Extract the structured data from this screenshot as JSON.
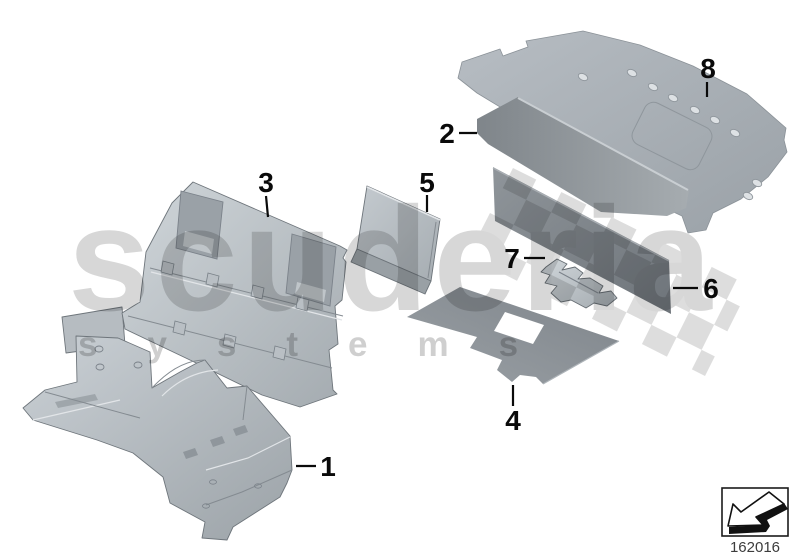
{
  "diagram": {
    "type": "exploded-parts-diagram",
    "subject": "sound insulation panels",
    "callouts": [
      {
        "label": "1"
      },
      {
        "label": "2"
      },
      {
        "label": "3"
      },
      {
        "label": "4"
      },
      {
        "label": "5"
      },
      {
        "label": "6"
      },
      {
        "label": "7"
      },
      {
        "label": "8"
      }
    ]
  },
  "watermark": {
    "brand": "scuderia",
    "systems": "systems",
    "flag": "checkered-flag-band"
  },
  "footer": {
    "drawing_number": "162016",
    "icon": "arrow-down-left-3d"
  },
  "colors": {
    "background": "#ffffff",
    "part_light": "#c9cfd4",
    "part_mid": "#9aa1a6",
    "part_dark": "#7d8388",
    "outline": "#6e757b",
    "label": "#0a0a0a",
    "watermark_gray": "#d7d7d7"
  }
}
